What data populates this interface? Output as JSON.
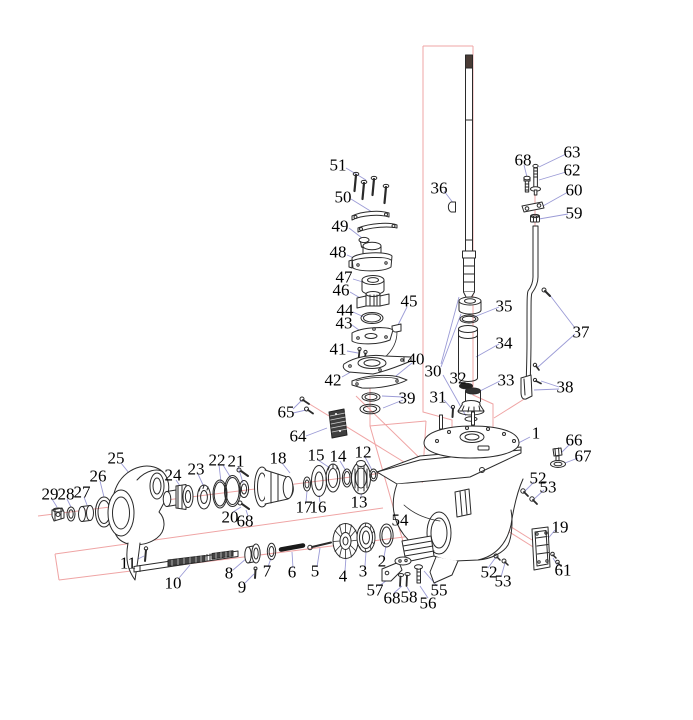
{
  "diagram": {
    "type": "exploded-parts-diagram",
    "subject": "outboard-lower-unit-gearcase",
    "callouts": [
      {
        "n": "51",
        "x": 338,
        "y": 165
      },
      {
        "n": "50",
        "x": 343,
        "y": 197
      },
      {
        "n": "49",
        "x": 340,
        "y": 226
      },
      {
        "n": "48",
        "x": 338,
        "y": 252
      },
      {
        "n": "47",
        "x": 344,
        "y": 277
      },
      {
        "n": "46",
        "x": 341,
        "y": 290
      },
      {
        "n": "44",
        "x": 345,
        "y": 310
      },
      {
        "n": "43",
        "x": 344,
        "y": 323
      },
      {
        "n": "45",
        "x": 409,
        "y": 301
      },
      {
        "n": "41",
        "x": 338,
        "y": 349
      },
      {
        "n": "42",
        "x": 333,
        "y": 380
      },
      {
        "n": "40",
        "x": 416,
        "y": 359
      },
      {
        "n": "39",
        "x": 407,
        "y": 398
      },
      {
        "n": "36",
        "x": 439,
        "y": 188
      },
      {
        "n": "30",
        "x": 433,
        "y": 371
      },
      {
        "n": "31",
        "x": 438,
        "y": 397
      },
      {
        "n": "32",
        "x": 458,
        "y": 378
      },
      {
        "n": "33",
        "x": 506,
        "y": 380
      },
      {
        "n": "34",
        "x": 504,
        "y": 343
      },
      {
        "n": "35",
        "x": 504,
        "y": 306
      },
      {
        "n": "68",
        "x": 523,
        "y": 160
      },
      {
        "n": "63",
        "x": 572,
        "y": 152
      },
      {
        "n": "62",
        "x": 572,
        "y": 170
      },
      {
        "n": "60",
        "x": 574,
        "y": 190
      },
      {
        "n": "59",
        "x": 574,
        "y": 213
      },
      {
        "n": "37",
        "x": 581,
        "y": 332
      },
      {
        "n": "38",
        "x": 565,
        "y": 387
      },
      {
        "n": "1",
        "x": 536,
        "y": 433
      },
      {
        "n": "66",
        "x": 574,
        "y": 440
      },
      {
        "n": "67",
        "x": 583,
        "y": 456
      },
      {
        "n": "52",
        "x": 538,
        "y": 478
      },
      {
        "n": "53",
        "x": 548,
        "y": 487
      },
      {
        "n": "19",
        "x": 560,
        "y": 527
      },
      {
        "n": "61",
        "x": 563,
        "y": 570
      },
      {
        "n": "52",
        "x": 489,
        "y": 572
      },
      {
        "n": "53",
        "x": 503,
        "y": 581
      },
      {
        "n": "54",
        "x": 400,
        "y": 520
      },
      {
        "n": "55",
        "x": 439,
        "y": 590
      },
      {
        "n": "56",
        "x": 428,
        "y": 603
      },
      {
        "n": "57",
        "x": 375,
        "y": 590
      },
      {
        "n": "68",
        "x": 392,
        "y": 598
      },
      {
        "n": "58",
        "x": 409,
        "y": 597
      },
      {
        "n": "65",
        "x": 286,
        "y": 412
      },
      {
        "n": "64",
        "x": 298,
        "y": 436
      },
      {
        "n": "25",
        "x": 116,
        "y": 458
      },
      {
        "n": "26",
        "x": 98,
        "y": 476
      },
      {
        "n": "27",
        "x": 82,
        "y": 492
      },
      {
        "n": "28",
        "x": 66,
        "y": 494
      },
      {
        "n": "29",
        "x": 50,
        "y": 494
      },
      {
        "n": "24",
        "x": 173,
        "y": 475
      },
      {
        "n": "23",
        "x": 196,
        "y": 469
      },
      {
        "n": "22",
        "x": 217,
        "y": 460
      },
      {
        "n": "21",
        "x": 236,
        "y": 461
      },
      {
        "n": "20",
        "x": 230,
        "y": 517
      },
      {
        "n": "68",
        "x": 245,
        "y": 521
      },
      {
        "n": "18",
        "x": 278,
        "y": 458
      },
      {
        "n": "15",
        "x": 316,
        "y": 455
      },
      {
        "n": "14",
        "x": 338,
        "y": 456
      },
      {
        "n": "12",
        "x": 363,
        "y": 452
      },
      {
        "n": "13",
        "x": 359,
        "y": 502
      },
      {
        "n": "17",
        "x": 304,
        "y": 507
      },
      {
        "n": "16",
        "x": 318,
        "y": 507
      },
      {
        "n": "11",
        "x": 128,
        "y": 563
      },
      {
        "n": "10",
        "x": 173,
        "y": 583
      },
      {
        "n": "9",
        "x": 242,
        "y": 587
      },
      {
        "n": "8",
        "x": 229,
        "y": 573
      },
      {
        "n": "7",
        "x": 267,
        "y": 571
      },
      {
        "n": "6",
        "x": 292,
        "y": 572
      },
      {
        "n": "5",
        "x": 315,
        "y": 571
      },
      {
        "n": "4",
        "x": 343,
        "y": 576
      },
      {
        "n": "3",
        "x": 363,
        "y": 571
      },
      {
        "n": "2",
        "x": 382,
        "y": 561
      }
    ]
  },
  "colors": {
    "ink": "#2a2a2a",
    "leader_line": "#9b9bd6",
    "construction_line": "#efa4a4",
    "background": "#ffffff",
    "shaft_tip": "#4a3c36"
  }
}
